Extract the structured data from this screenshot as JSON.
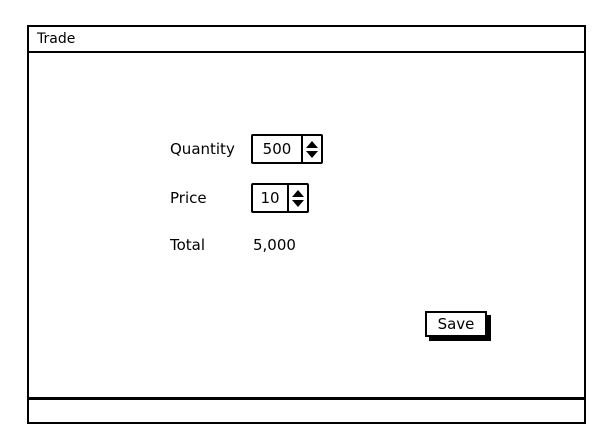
{
  "window": {
    "title": "Trade"
  },
  "form": {
    "quantity": {
      "label": "Quantity",
      "value": "500"
    },
    "price": {
      "label": "Price",
      "value": "10"
    },
    "total": {
      "label": "Total",
      "value": "5,000"
    }
  },
  "buttons": {
    "save": "Save"
  },
  "icons": {
    "spinner_up": "black up-pointing triangle",
    "spinner_down": "black down-pointing triangle"
  },
  "colors": {
    "border": "#000000",
    "background": "#ffffff",
    "text": "#000000"
  }
}
